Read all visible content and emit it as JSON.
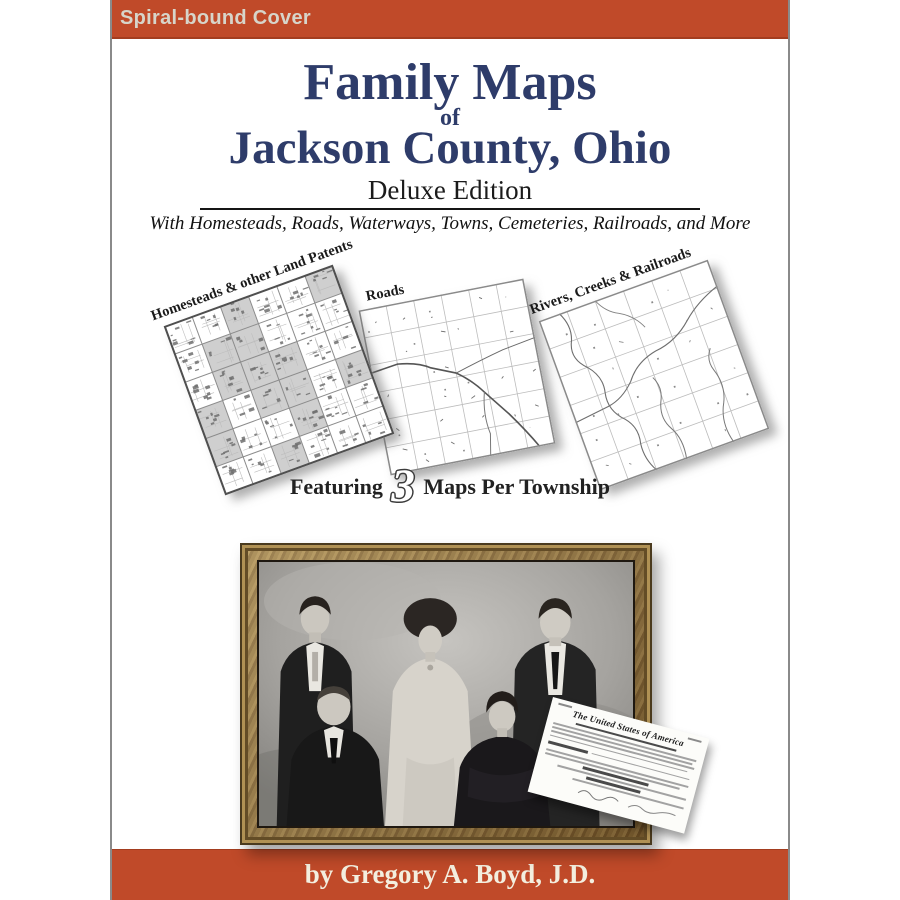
{
  "banner": {
    "label": "Spiral-bound Cover"
  },
  "title": {
    "line1": "Family Maps",
    "of": "of",
    "line2": "Jackson County, Ohio",
    "edition": "Deluxe Edition",
    "tagline": "With Homesteads, Roads, Waterways, Towns, Cemeteries, Railroads, and More"
  },
  "maps": {
    "items": [
      {
        "label": "Homesteads & other Land Patents"
      },
      {
        "label": "Roads"
      },
      {
        "label": "Rivers, Creeks & Railroads"
      }
    ],
    "featuring": {
      "prefix": "Featuring",
      "count": "3",
      "suffix": "Maps Per Township"
    }
  },
  "document": {
    "title": "The United States of America"
  },
  "footer": {
    "byline": "by Gregory A. Boyd, J.D."
  },
  "colors": {
    "accent": "#c04a29",
    "title_navy": "#2e3c6a",
    "byline_text": "#f3efdf",
    "banner_text": "#d7d5ca"
  }
}
